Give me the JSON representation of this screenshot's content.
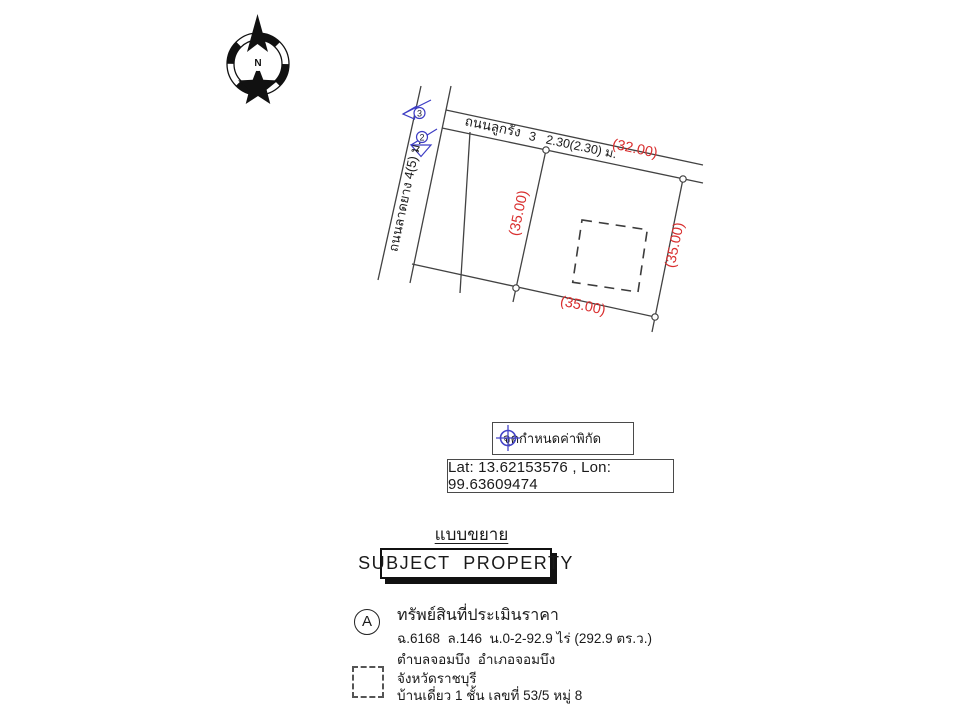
{
  "map": {
    "compass_label": "N",
    "top_road_label": "ถนนลูกรัง",
    "top_road_width_label": "3   2.30(2.30) ม.",
    "left_road_label": "ถนนลาดยาง 4(5) ม.",
    "dim_top": "(32.00)",
    "dim_left": "(35.00)",
    "dim_right": "(35.00)",
    "dim_bottom": "(35.00)",
    "survey_marker_3": "3",
    "survey_marker_2": "2"
  },
  "legend": {
    "coordinate_point_label": "จุดกำหนดค่าพิกัด",
    "coordinates": "Lat: 13.62153576 , Lon: 99.63609474"
  },
  "titles": {
    "section_title": "แบบขยาย",
    "subject_property_label": "SUBJECT  PROPERTY"
  },
  "property": {
    "marker_label": "A",
    "title": "ทรัพย์สินที่ประเมินราคา",
    "deed_info": "ฉ.6168  ล.146  น.0-2-92.9 ไร่ (292.9 ตร.ว.)",
    "location_line1": "ตำบลจอมบึง  อำเภอจอมบึง",
    "location_line2": "จังหวัดราชบุรี",
    "building_info": "บ้านเดี่ยว 1 ชั้น เลขที่ 53/5 หมู่ 8"
  },
  "colors": {
    "dimension_red": "#d92f2f",
    "marker_blue": "#3d3dc4",
    "line_color": "#424242"
  }
}
